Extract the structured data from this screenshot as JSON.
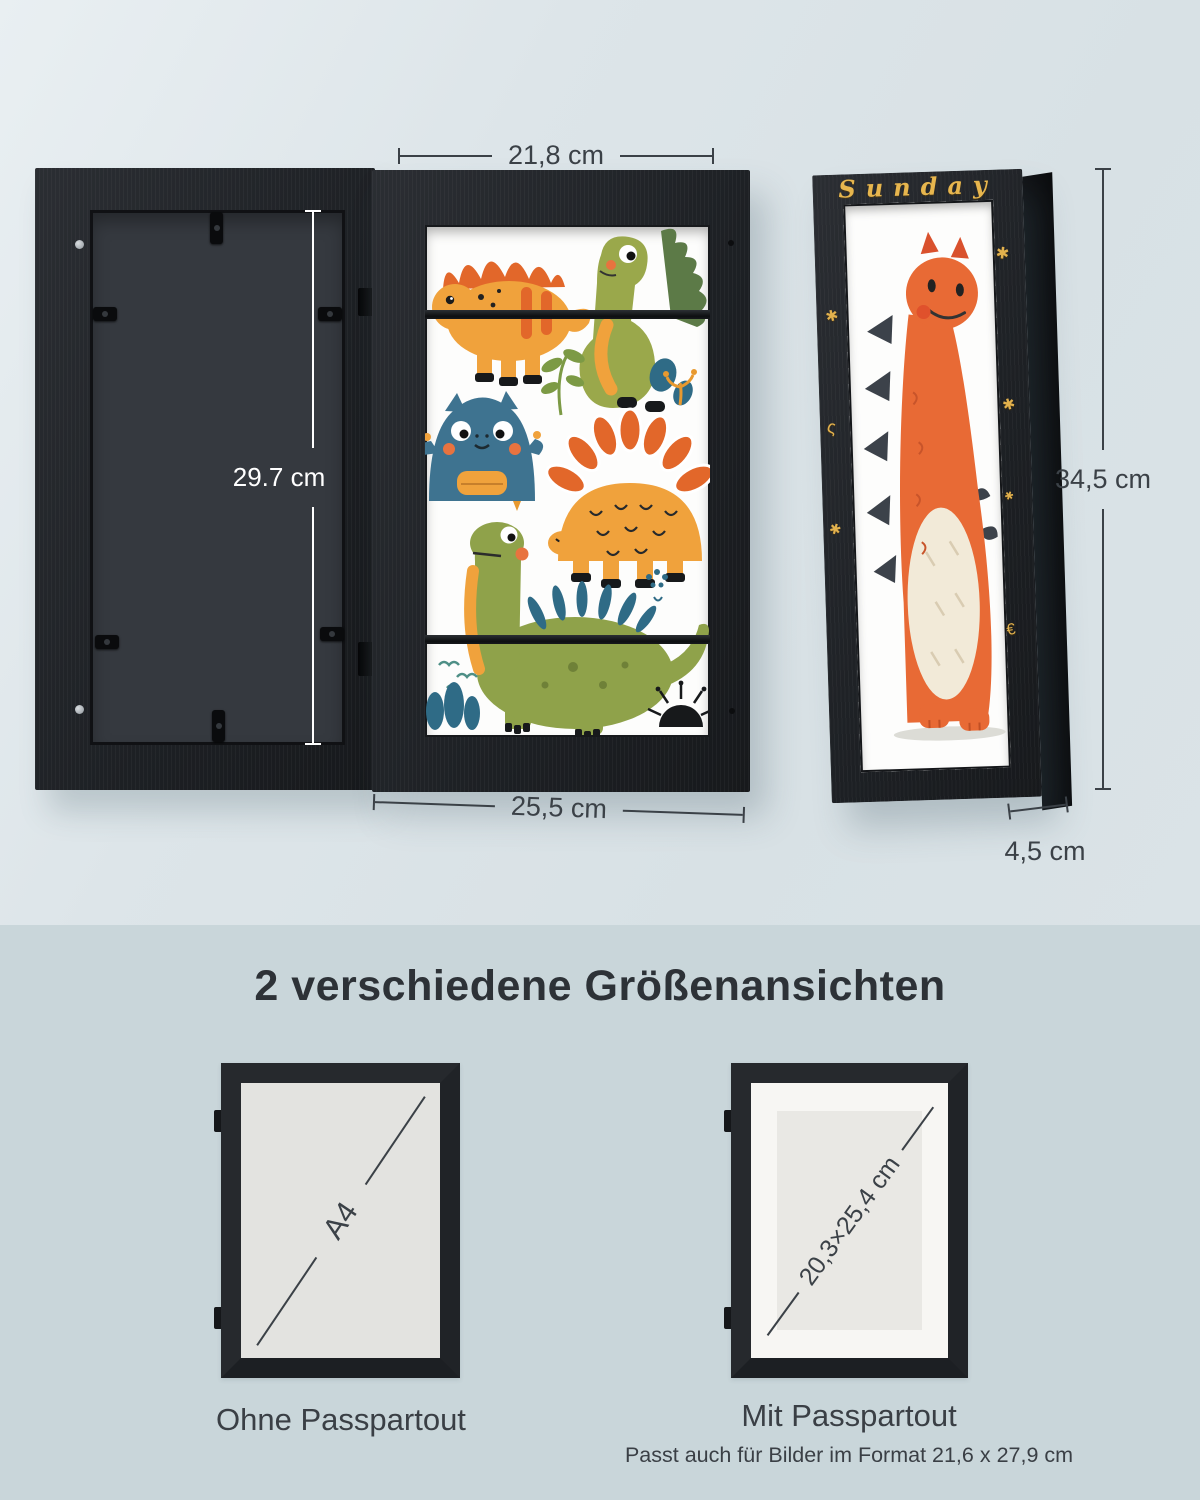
{
  "section_top": {
    "dim_inner_width": "21,8 cm",
    "dim_back_height": "29.7 cm",
    "dim_outer_width": "25,5 cm",
    "dim_side_height": "34,5 cm",
    "dim_depth": "4,5 cm",
    "side_frame_word": "Sunday",
    "side_frame_doodles": [
      "✱",
      "ς",
      "✱",
      "✱",
      "✱",
      "✱",
      "€"
    ]
  },
  "section_bottom": {
    "heading": "2 verschiedene Größenansichten",
    "variant_left": {
      "diagonal_label": "A4",
      "caption": "Ohne Passpartout"
    },
    "variant_right": {
      "diagonal_label": "20,3×25,4 cm",
      "caption": "Mit Passpartout",
      "note": "Passt auch für Bilder im Format 21,6 x 27,9 cm"
    }
  },
  "colors": {
    "background_top": "#dae3e7",
    "background_bottom": "#c9d6da",
    "frame_black": "#23262a",
    "gold_decor": "#e2b14d",
    "dimension_line": "#3b4147",
    "art_white": "#fdfdfc"
  }
}
